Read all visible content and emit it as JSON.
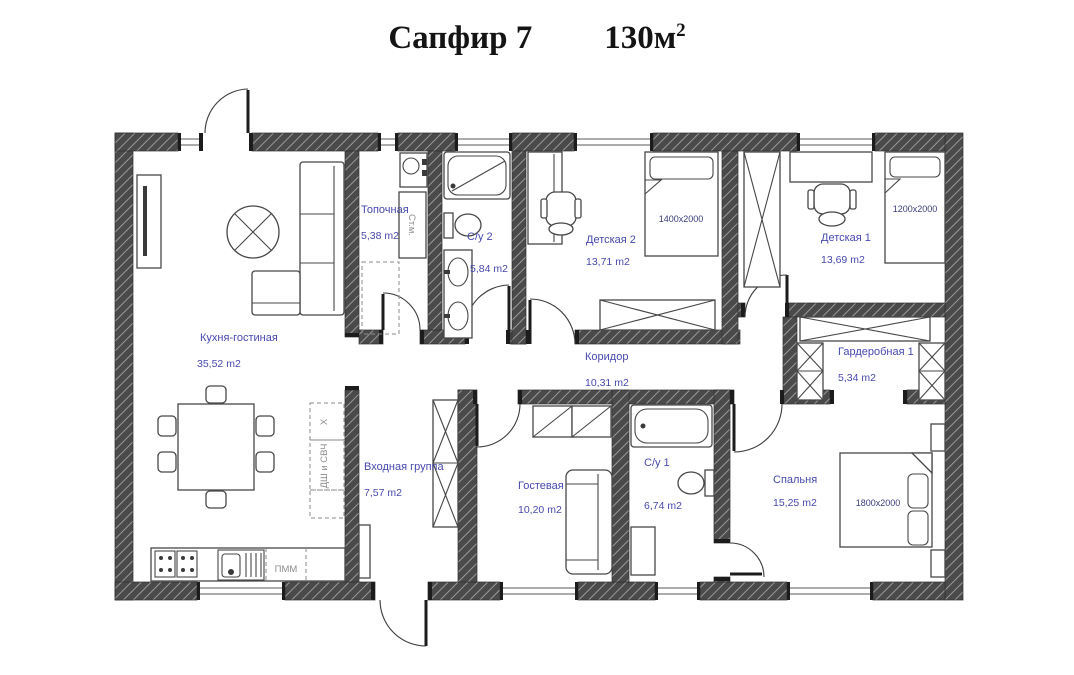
{
  "title": {
    "name": "Сапфир 7",
    "area_value": "130м",
    "area_sup": "2"
  },
  "rooms": [
    {
      "id": "kitchen_living",
      "label": "Кухня-гостиная",
      "area": "35,52 m2"
    },
    {
      "id": "boiler",
      "label": "Топочная",
      "area": "5,38 m2"
    },
    {
      "id": "bathroom2",
      "label": "С/у 2",
      "area": "5,84 m2"
    },
    {
      "id": "kids2",
      "label": "Детская 2",
      "area": "13,71 m2",
      "bed": "1400x2000"
    },
    {
      "id": "kids1",
      "label": "Детская 1",
      "area": "13,69 m2",
      "bed": "1200x2000"
    },
    {
      "id": "corridor",
      "label": "Коридор",
      "area": "10,31 m2"
    },
    {
      "id": "wardrobe1",
      "label": "Гардеробная 1",
      "area": "5,34 m2"
    },
    {
      "id": "entrance",
      "label": "Входная группа",
      "area": "7,57 m2"
    },
    {
      "id": "guest",
      "label": "Гостевая",
      "area": "10,20 m2"
    },
    {
      "id": "bathroom1",
      "label": "С/у 1",
      "area": "6,74 m2"
    },
    {
      "id": "bedroom",
      "label": "Спальня",
      "area": "15,25 m2",
      "bed": "1800x2000"
    }
  ],
  "appliances": {
    "washing_machine": "Ст.м.",
    "dishwasher": "ПММ",
    "fridge": "Х",
    "oven_microwave": "ДШ и СВЧ"
  },
  "colors": {
    "wall": "#4a4a4a",
    "wall_hatch": "#999999",
    "room_label": "#4749ae",
    "bed_dim": "#3a3b7a",
    "appliance_label": "#8d8d8d",
    "title": "#141414"
  }
}
